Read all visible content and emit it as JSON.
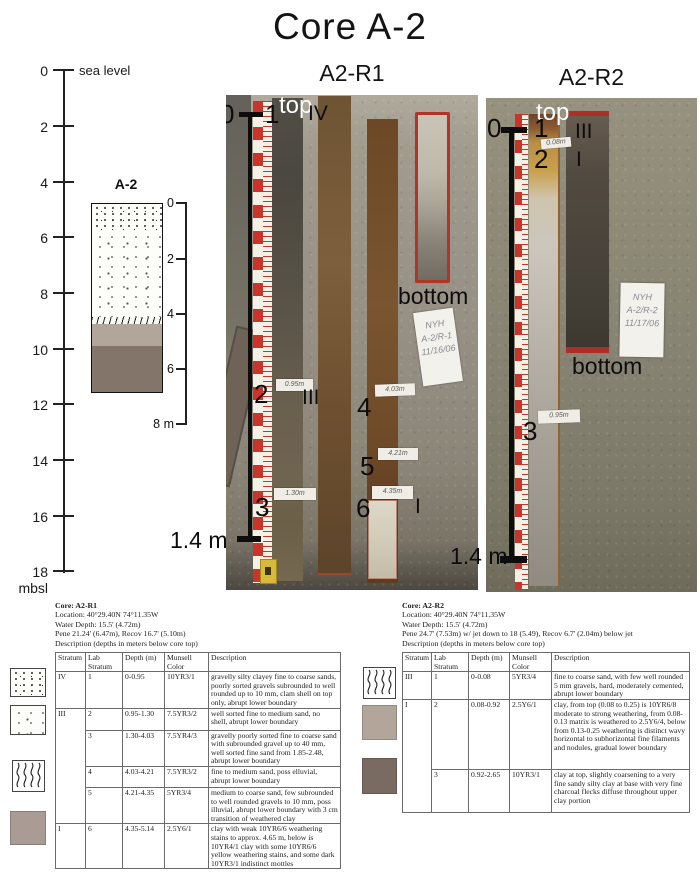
{
  "title": "Core A-2",
  "depth_scale": {
    "sea_level": "sea level",
    "labels": [
      "0",
      "2",
      "4",
      "6",
      "8",
      "10",
      "12",
      "14",
      "16",
      "18 mbsl"
    ]
  },
  "strat_column": {
    "label": "A-2",
    "ticks": [
      "0",
      "2",
      "4",
      "6",
      "8 m"
    ]
  },
  "photo_r1": {
    "title": "A2-R1",
    "top_label": "top",
    "bottom_label": "bottom",
    "zero": "0",
    "length": "1.4 m",
    "markers": {
      "m1": "1",
      "m2": "2",
      "m3": "3",
      "m4": "4",
      "m5": "5",
      "m6": "6"
    },
    "strata": {
      "s1": "IV",
      "s2": "III",
      "s3": "I"
    },
    "tags": {
      "t2": "0.95m",
      "t3": "1.30m",
      "t4": "4.03m",
      "t5": "4.21m",
      "t6": "4.35m"
    },
    "paper": [
      "NYH",
      "A-2/R-1",
      "11/16/06"
    ]
  },
  "photo_r2": {
    "title": "A2-R2",
    "top_label": "top",
    "bottom_label": "bottom",
    "zero": "0",
    "length": "1.4 m",
    "markers": {
      "m1": "1",
      "m2": "2",
      "m3": "3"
    },
    "strata": {
      "s1": "III",
      "s2": "I"
    },
    "tags": {
      "t2": "0.08m",
      "t3": "0.95m"
    },
    "paper": [
      "NYH",
      "A-2/R-2",
      "11/17/06"
    ]
  },
  "table_r1": {
    "info": [
      "Core: A2-R1",
      "Location: 40°29.40N 74°11.35W",
      "Water Depth: 15.5' (4.72m)",
      "Pene 21.24' (6.47m), Recov 16.7' (5.10m)",
      "Description (depths in meters below core top)"
    ],
    "columns": [
      "Stratum",
      "Lab Stratum",
      "Depth (m)",
      "Munsell Color",
      "Description"
    ],
    "rows": [
      {
        "stratum": "IV",
        "lab": "1",
        "depth": "0-0.95",
        "munsell": "10YR3/1",
        "desc": "gravelly silty clayey fine to coarse sands, poorly sorted gravels subrounded to well rounded up to 10 mm, clam shell on top only, abrupt lower boundary"
      },
      {
        "stratum": "III",
        "lab": "2",
        "depth": "0.95-1.30",
        "munsell": "7.5YR3/2",
        "desc": "well sorted fine to medium sand, no shell, abrupt lower boundary"
      },
      {
        "stratum": "",
        "lab": "3",
        "depth": "1.30-4.03",
        "munsell": "7.5YR4/3",
        "desc": "gravelly poorly sorted fine to coarse sand with subrounded gravel up to 40 mm, well sorted fine sand from 1.85-2.48, abrupt lower boundary"
      },
      {
        "stratum": "",
        "lab": "4",
        "depth": "4.03-4.21",
        "munsell": "7.5YR3/2",
        "desc": "fine to medium sand, poss elluvial, abrupt lower boundary"
      },
      {
        "stratum": "",
        "lab": "5",
        "depth": "4.21-4.35",
        "munsell": "5YR3/4",
        "desc": "medium to coarse sand, few subrounded to well rounded gravels to 10 mm, poss illuvial, abrupt lower boundary with 3 cm transition of weathered clay"
      },
      {
        "stratum": "I",
        "lab": "6",
        "depth": "4.35-5.14",
        "munsell": "2.5Y6/1",
        "desc": "clay with weak 10YR6/6 weathering stains to approx. 4.65 m, below is 10YR4/1 clay with some 10YR6/6 yellow weathering stains, and some dark 10YR3/1 indistinct mottles"
      }
    ]
  },
  "table_r2": {
    "info": [
      "Core: A2-R2",
      "Location: 40°29.40N 74°11.35W",
      "Water Depth: 15.5' (4.72m)",
      "Pene 24.7' (7.53m) w/ jet down to 18 (5.49), Recov 6.7' (2.04m) below jet",
      "Description (depths in meters below core top)"
    ],
    "columns": [
      "Stratum",
      "Lab Stratum",
      "Depth (m)",
      "Munsell Color",
      "Description"
    ],
    "rows": [
      {
        "stratum": "III",
        "lab": "1",
        "depth": "0-0.08",
        "munsell": "5YR3/4",
        "desc": "fine to coarse sand, with few well rounded 5 mm gravels, hard, moderately cemented, abrupt lower boundary"
      },
      {
        "stratum": "I",
        "lab": "2",
        "depth": "0.08-0.92",
        "munsell": "2.5Y6/1",
        "desc": "clay, from top (0.08 to 0.25) is 10YR6/8 moderate to strong weathering, from 0.08-0.13 matrix is weathered to 2.5Y6/4, below from 0.13-0.25 weathering is distinct wavy horizontal to subhorizontal fine filaments and nodules, gradual lower boundary"
      },
      {
        "stratum": "",
        "lab": "3",
        "depth": "0.92-2.65",
        "munsell": "10YR3/1",
        "desc": "clay at top, slightly coarsening to a very fine sandy silty clay at base with very fine charcoal flecks diffuse throughout upper clay portion"
      }
    ]
  },
  "colors": {
    "clay_light": "#b2a69a",
    "clay_dark": "#84756b",
    "swatch_gray": "#a89c94",
    "swatch_dark": "#7a6b62",
    "tray_red": "#b13429",
    "ruler_red": "#c8352b"
  }
}
